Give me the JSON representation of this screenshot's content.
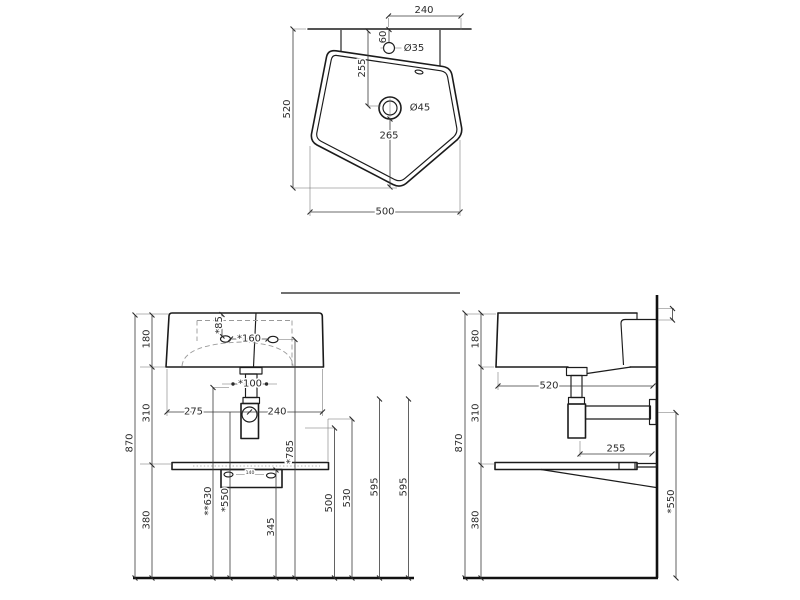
{
  "drawing": {
    "background": "#ffffff",
    "object_line_color": "#1b1b1b",
    "dimension_line_color": "#3a3a3a",
    "hidden_line_color": "#9a9a9a"
  },
  "top_view": {
    "labels": {
      "rim_width": "240",
      "tap_offset": "60",
      "tap_diameter": "Ø35",
      "drain_from_back": "255",
      "drain_diameter": "Ø45",
      "drain_from_front": "265",
      "depth": "520",
      "width": "500"
    }
  },
  "front_view": {
    "labels": {
      "basin_height": "180",
      "mid_height": "310",
      "total_height": "870",
      "lower_height": "380",
      "tap_from_top": "*85",
      "tap_spacing": "*160",
      "outlet_hole": "*100",
      "drain_from_left": "275",
      "drain_from_right": "240",
      "bracket_holes": "140",
      "outlet_height": "**630",
      "trap_outlet_height": "*550",
      "shelf_clearance": "345",
      "tap_height": "*785",
      "ref_500": "500",
      "ref_530": "530",
      "ref_595_a": "595",
      "ref_595_b": "595"
    }
  },
  "side_view": {
    "labels": {
      "basin_height": "180",
      "depth": "520",
      "mid_height": "310",
      "total_height": "870",
      "lower_height": "380",
      "shelf_depth": "255",
      "pipe_height": "*550"
    }
  }
}
